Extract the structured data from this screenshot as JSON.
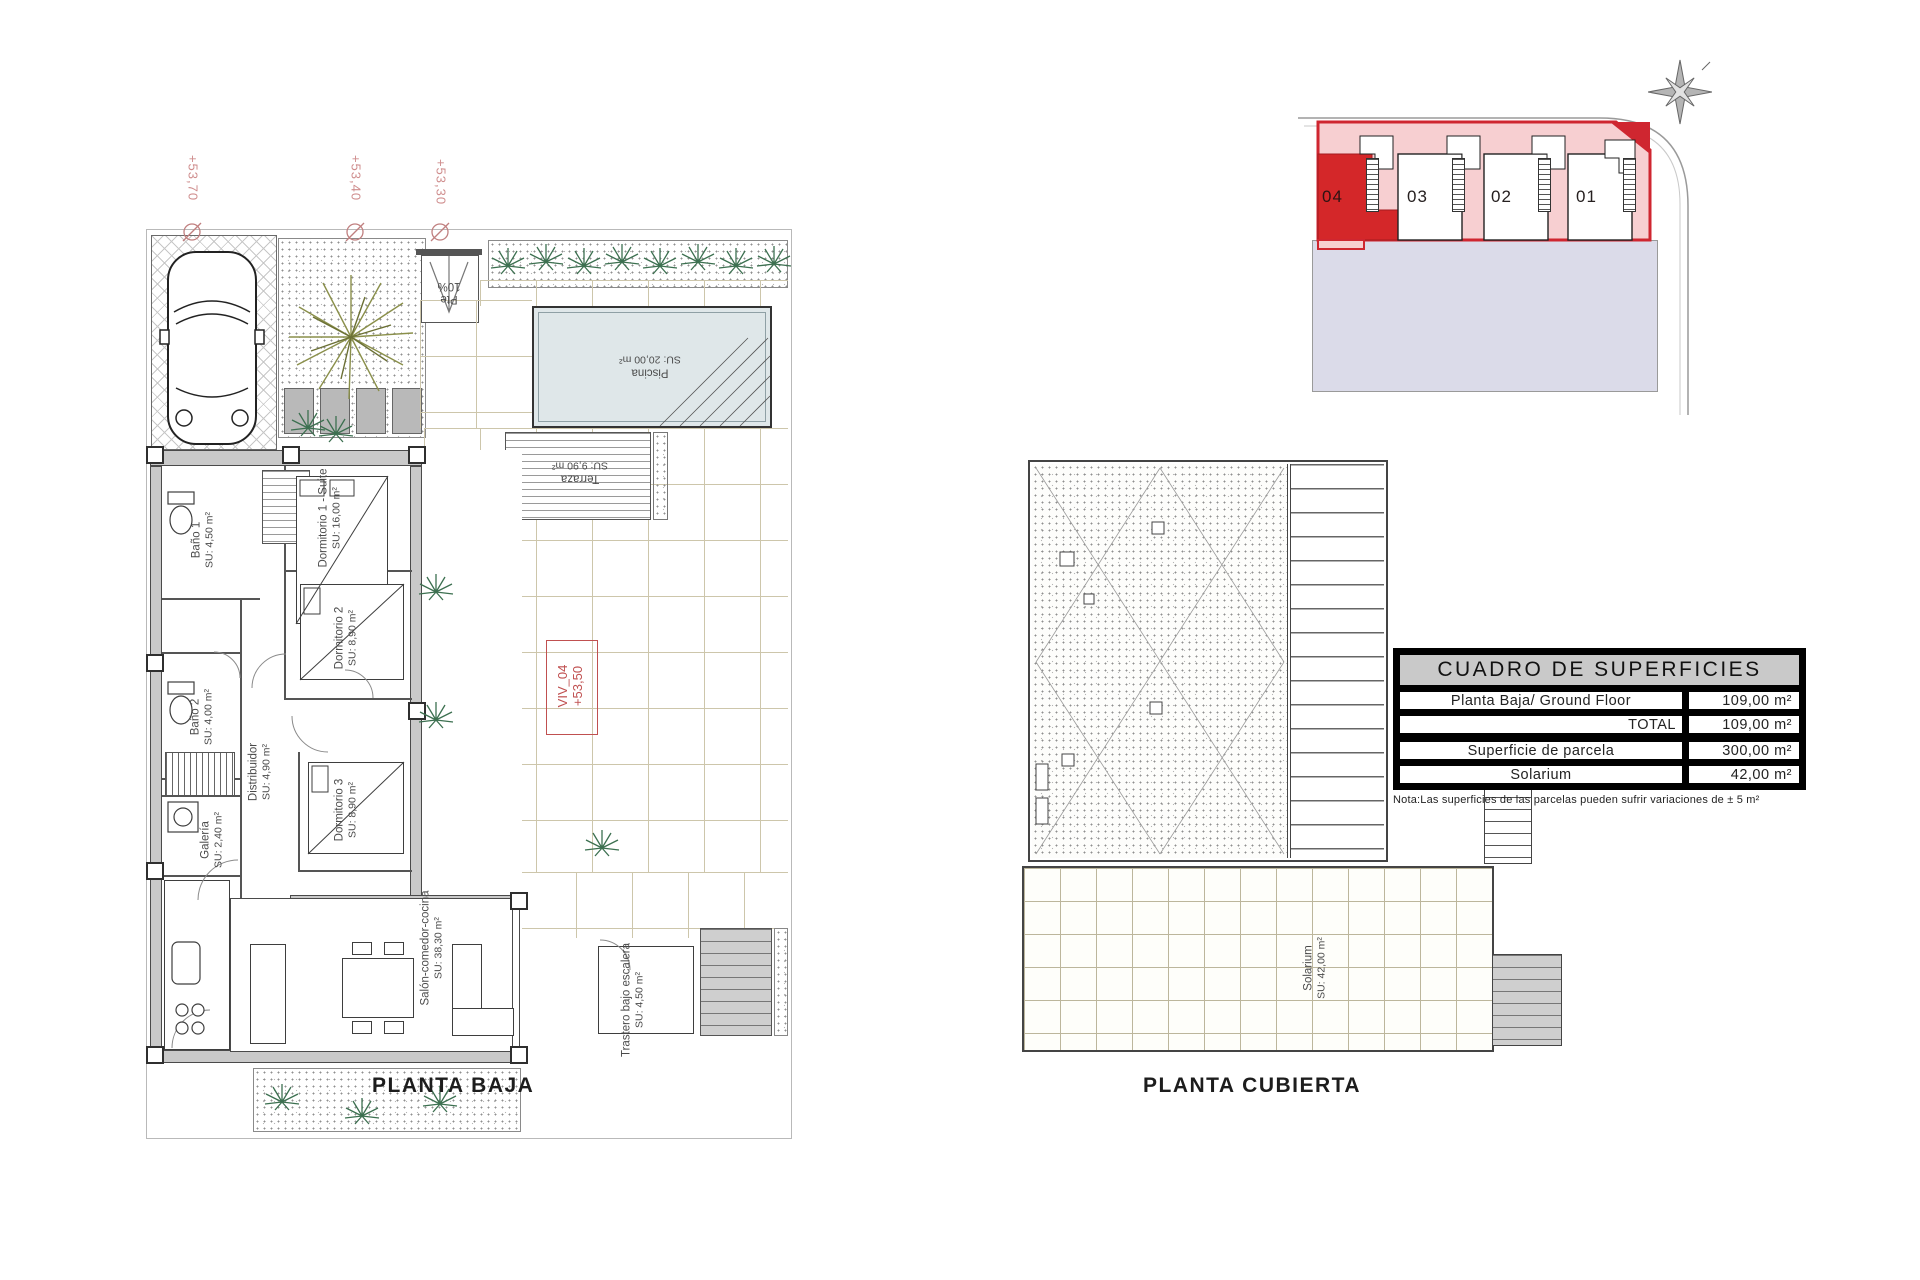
{
  "titles": {
    "ground_floor": "PLANTA BAJA",
    "roof": "PLANTA CUBIERTA"
  },
  "marks": {
    "elev1": "+53,70",
    "elev2": "+53,40",
    "elev3": "+53,30",
    "viv1": "VIV_04",
    "viv2": "+53,50",
    "ramp1": "Pte",
    "ramp2": "10%"
  },
  "rooms": {
    "banyo1": {
      "name": "Baño 1",
      "area": "SU: 4,50 m²"
    },
    "dorm1": {
      "name": "Dormitorio 1 - Suite",
      "area": "SU: 16,00 m²"
    },
    "dorm2": {
      "name": "Dormitorio 2",
      "area": "SU: 8,90 m²"
    },
    "banyo2": {
      "name": "Baño 2",
      "area": "SU: 4,00 m²"
    },
    "distribuidor": {
      "name": "Distribuidor",
      "area": "SU: 4,90 m²"
    },
    "dorm3": {
      "name": "Dormitorio 3",
      "area": "SU: 8,90 m²"
    },
    "galeria": {
      "name": "Galería",
      "area": "SU: 2,40 m²"
    },
    "salon": {
      "name": "Salón-comedor-cocina",
      "area": "SU: 38,30 m²"
    },
    "trastero": {
      "name": "Trastero bajo escalera",
      "area": "SU: 4,50 m²"
    },
    "piscina": {
      "name": "Piscina",
      "area": "SU: 20,00 m²"
    },
    "terraza": {
      "name": "Terraza",
      "area": "SU: 9,90 m²"
    },
    "solarium": {
      "name": "Solarium",
      "area": "SU: 42,00 m²"
    }
  },
  "site": {
    "units": [
      {
        "label": "04",
        "highlighted": true
      },
      {
        "label": "03",
        "highlighted": false
      },
      {
        "label": "02",
        "highlighted": false
      },
      {
        "label": "01",
        "highlighted": false
      }
    ]
  },
  "surfaces_table": {
    "title": "CUADRO DE SUPERFICIES",
    "rows": [
      {
        "label": "Planta Baja/ Ground Floor",
        "value": "109,00 m²"
      },
      {
        "label": "TOTAL",
        "value": "109,00 m²"
      },
      {
        "label": "Superficie de parcela",
        "value": "300,00 m²"
      },
      {
        "label": "Solarium",
        "value": "42,00 m²"
      }
    ],
    "note": "Nota:Las superficies de las parcelas pueden sufrir variaciones de ± 5 m²"
  },
  "colors": {
    "accent_red": "#cf2630",
    "unit_highlight": "#d42729",
    "parcel_pink": "#f7cfd1",
    "street_lavender": "#dbdbe9",
    "pool_blue": "#dfe7e9",
    "elevation_pink": "#cf8d8d"
  }
}
